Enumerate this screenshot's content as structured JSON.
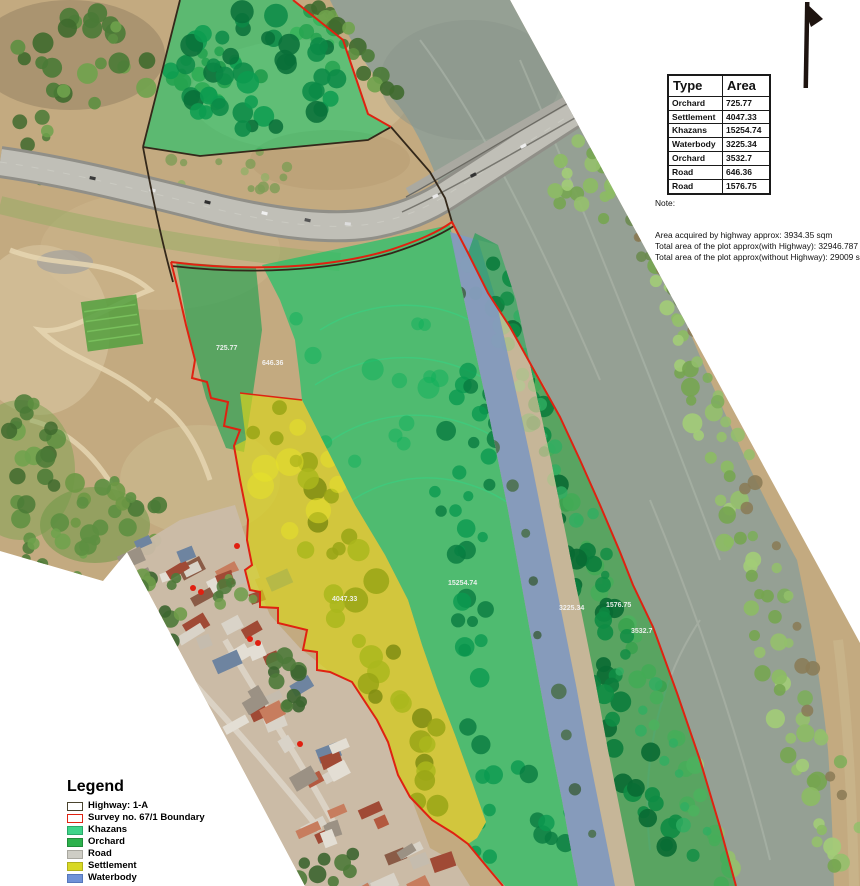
{
  "colors": {
    "terrain": "#c3aa80",
    "river": "#95a094",
    "khazans_overlay": "#08c565",
    "orchard_overlay": "#12a04c",
    "settlement_overlay": "#d9d31d",
    "waterbody_overlay": "#6f92d8",
    "road_overlay": "#c9c0ab",
    "survey_boundary": "#df2211",
    "highway_boundary": "#33281a",
    "label_text": "#f5f5f5"
  },
  "table": {
    "headers": [
      "Type",
      "Area"
    ],
    "rows": [
      [
        "Orchard",
        "725.77"
      ],
      [
        "Settlement",
        "4047.33"
      ],
      [
        "Khazans",
        "15254.74"
      ],
      [
        "Waterbody",
        "3225.34"
      ],
      [
        "Orchard",
        "3532.7"
      ],
      [
        "Road",
        "646.36"
      ],
      [
        "Road",
        "1576.75"
      ]
    ]
  },
  "note": {
    "title": "Note:",
    "lines": [
      "Area acquired by highway approx: 3934.35 sqm",
      "Total area of the plot approx(with Highway): 32946.787  sqm",
      "Total area of the plot approx(without Highway): 29009 sqm"
    ]
  },
  "legend": {
    "title": "Legend",
    "items": [
      {
        "label": "Highway: 1-A",
        "fill": "#ffffff",
        "border": "#4a442e"
      },
      {
        "label": "Survey no. 67/1 Boundary",
        "fill": "#ffffff",
        "border": "#df2211"
      },
      {
        "label": "Khazans",
        "fill": "#3fd489",
        "border": "#2aa968"
      },
      {
        "label": "Orchard",
        "fill": "#2cb14c",
        "border": "#1f8c3a"
      },
      {
        "label": "Road",
        "fill": "#cecdc5",
        "border": "#a8a79f"
      },
      {
        "label": "Settlement",
        "fill": "#d8d824",
        "border": "#b0b01c"
      },
      {
        "label": "Waterbody",
        "fill": "#6f92d8",
        "border": "#5577bb"
      }
    ]
  },
  "map_labels": [
    {
      "text": "725.77",
      "x": 216,
      "y": 350
    },
    {
      "text": "646.36",
      "x": 262,
      "y": 365
    },
    {
      "text": "15254.74",
      "x": 448,
      "y": 585
    },
    {
      "text": "4047.33",
      "x": 332,
      "y": 601
    },
    {
      "text": "3225.34",
      "x": 559,
      "y": 610
    },
    {
      "text": "1576.75",
      "x": 606,
      "y": 607
    },
    {
      "text": "3532.7",
      "x": 631,
      "y": 633
    }
  ]
}
